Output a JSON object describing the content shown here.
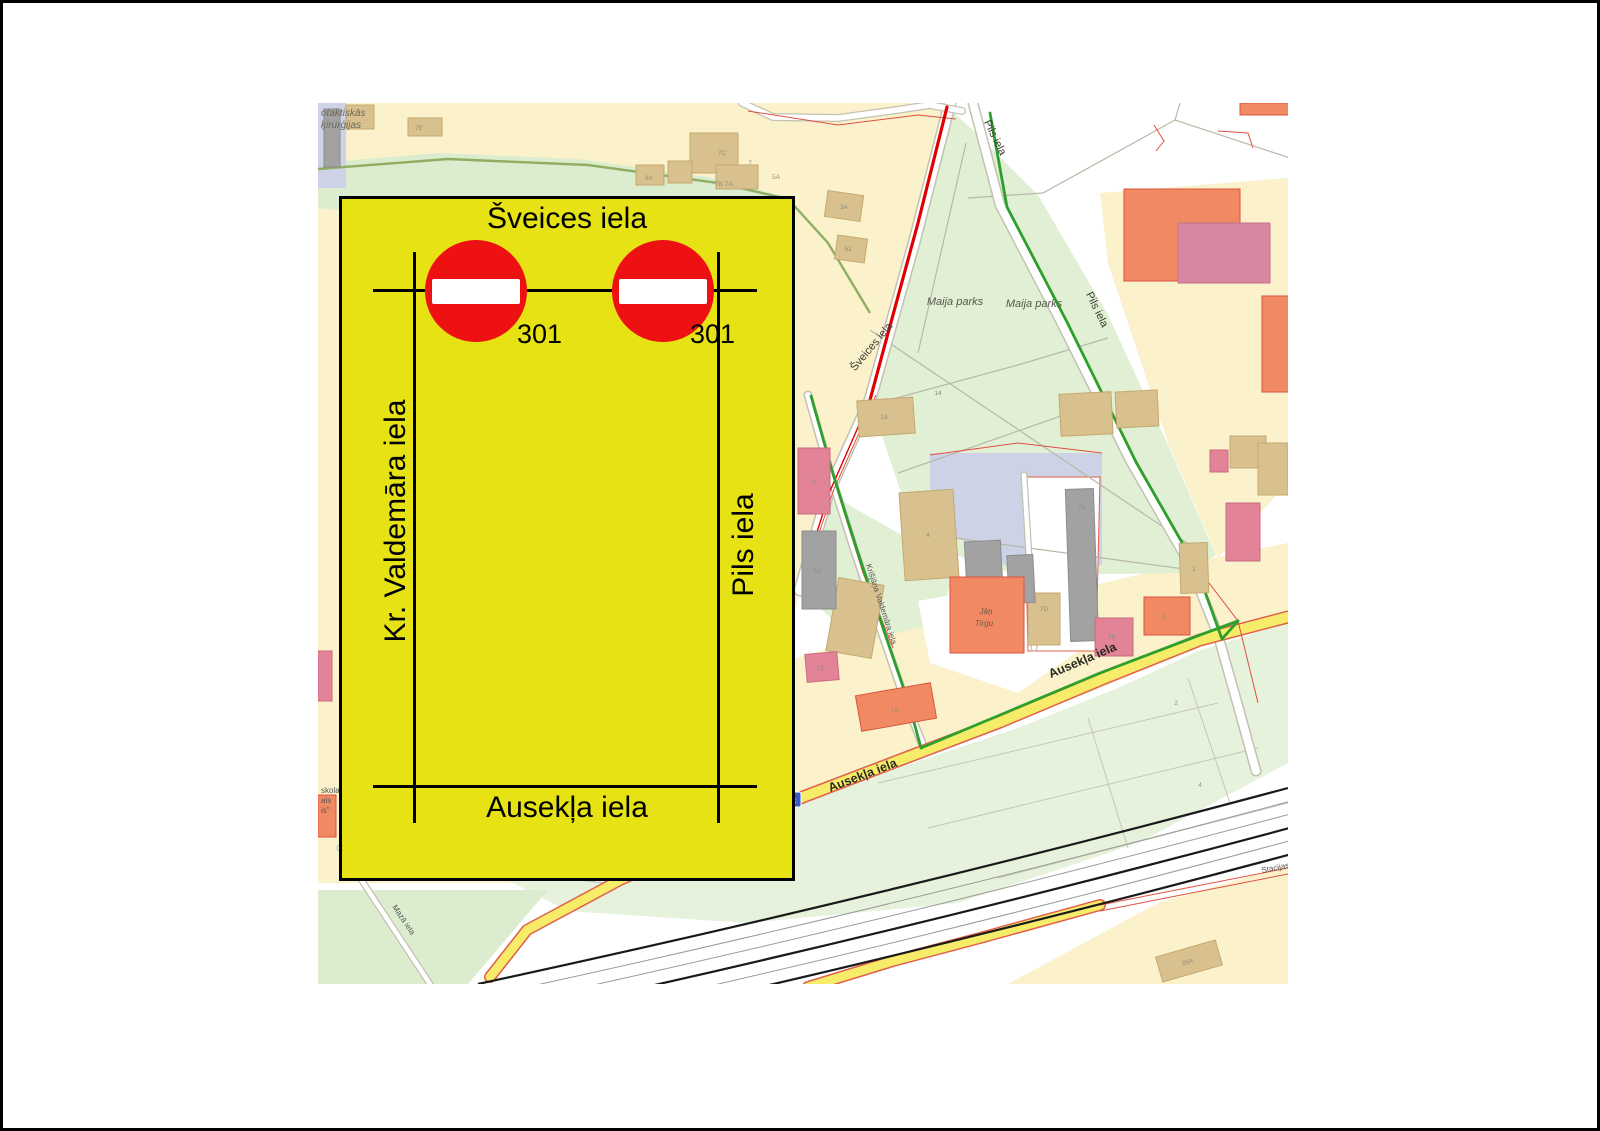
{
  "diagram": {
    "title": "Šveices iela",
    "left_street": "Kr. Valdemāra iela",
    "right_street": "Pils iela",
    "bottom_street": "Ausekļa iela",
    "sign1_code": "301",
    "sign2_code": "301",
    "sign_type": "no-entry-sign",
    "box_fill": "#e6e214",
    "sign_red": "#ee1111"
  },
  "map": {
    "colors": {
      "cream": "#fbf1cb",
      "park_green": "#e1efd5",
      "field_green": "#e6f2db",
      "route_green": "#2da02c",
      "route_red": "#e00000",
      "road_yellow": "#f7ec6a",
      "road_red_edge": "#e0604a",
      "building_tan": "#d9c18f",
      "building_orange": "#f18a62",
      "building_pink": "#e28398",
      "building_grey": "#a2a2a2",
      "parking_lavender": "#cdd2e6",
      "railway_black": "#1a1a1a",
      "shield_blue": "#3b5bc4"
    },
    "labels": [
      "otaktiskās",
      "ķirurģijas",
      "7E",
      "Šveices iela",
      "Pils iela",
      "Pils iela",
      "Maija parks",
      "Maija parks",
      "Ausekļa iela",
      "Ausekļa iela",
      "Mazā iela",
      "Stacijas",
      "Jāņ",
      "Tirgu",
      "skola",
      "ais",
      "is\"",
      "Krišjāņa Valdemāra iela",
      "7C",
      "7",
      "5A",
      "7B 7A",
      "9A",
      "3A",
      "51",
      "13",
      "14",
      "1",
      "4",
      "3A",
      "7A",
      "7D",
      "7B",
      "9",
      "2",
      "4",
      "26A",
      "1A",
      "1C",
      "1",
      "P8"
    ]
  }
}
